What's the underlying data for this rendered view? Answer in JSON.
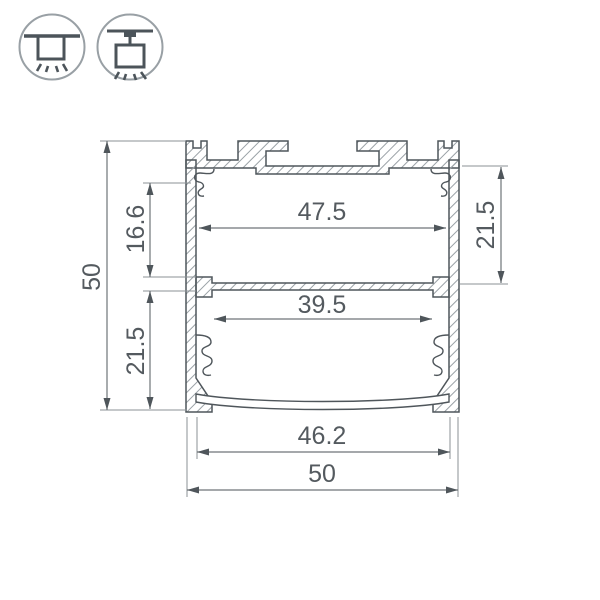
{
  "palette": {
    "background": "#ffffff",
    "outline": "#4f565b",
    "hatch": "#9aa1a6",
    "dimension_line": "#6f7579",
    "extension_line": "#8b9296",
    "text": "#545a5f",
    "icon_circle": "#99a0a5",
    "icon_glyph": "#4c545a"
  },
  "icons": {
    "surface_mount": {
      "name": "surface-mount-light-icon"
    },
    "pendant_mount": {
      "name": "pendant-mount-light-icon"
    }
  },
  "drawing": {
    "type": "aluminium-profile-cross-section",
    "dimensions": {
      "overall_height": {
        "label": "50"
      },
      "upper_chamber_height": {
        "label": "16.6"
      },
      "lower_chamber_height": {
        "label": "21.5"
      },
      "upper_inner_width": {
        "label": "47.5"
      },
      "upper_chamber_height_right": {
        "label": "21.5"
      },
      "lower_inner_width": {
        "label": "39.5"
      },
      "bottom_opening_width": {
        "label": "46.2"
      },
      "overall_width": {
        "label": "50"
      }
    }
  }
}
